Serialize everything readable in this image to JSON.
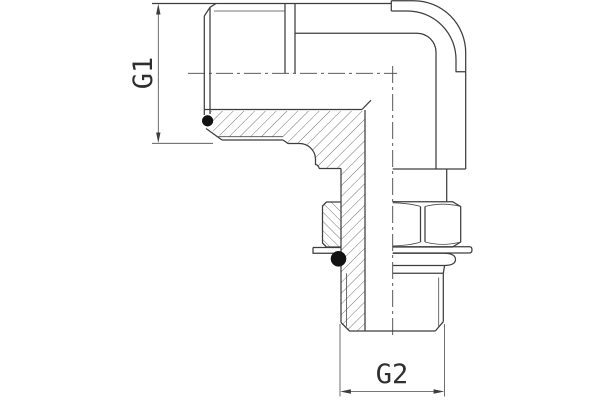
{
  "drawing": {
    "title": "90-degree male stud elbow fitting, half-section technical drawing",
    "dimensions": {
      "g1": {
        "label": "G1",
        "meaning": "left port thread size"
      },
      "g2": {
        "label": "G2",
        "meaning": "bottom port thread size"
      }
    },
    "parts": [
      "elbow body",
      "left male thread G1",
      "bottom male stud thread G2",
      "O-ring seal left port",
      "O-ring seal bottom port",
      "locknut",
      "washer"
    ],
    "colors": {
      "background": "#ffffff",
      "line": "#3d3d3d",
      "hatch": "#555555",
      "seal": "#121212"
    }
  }
}
